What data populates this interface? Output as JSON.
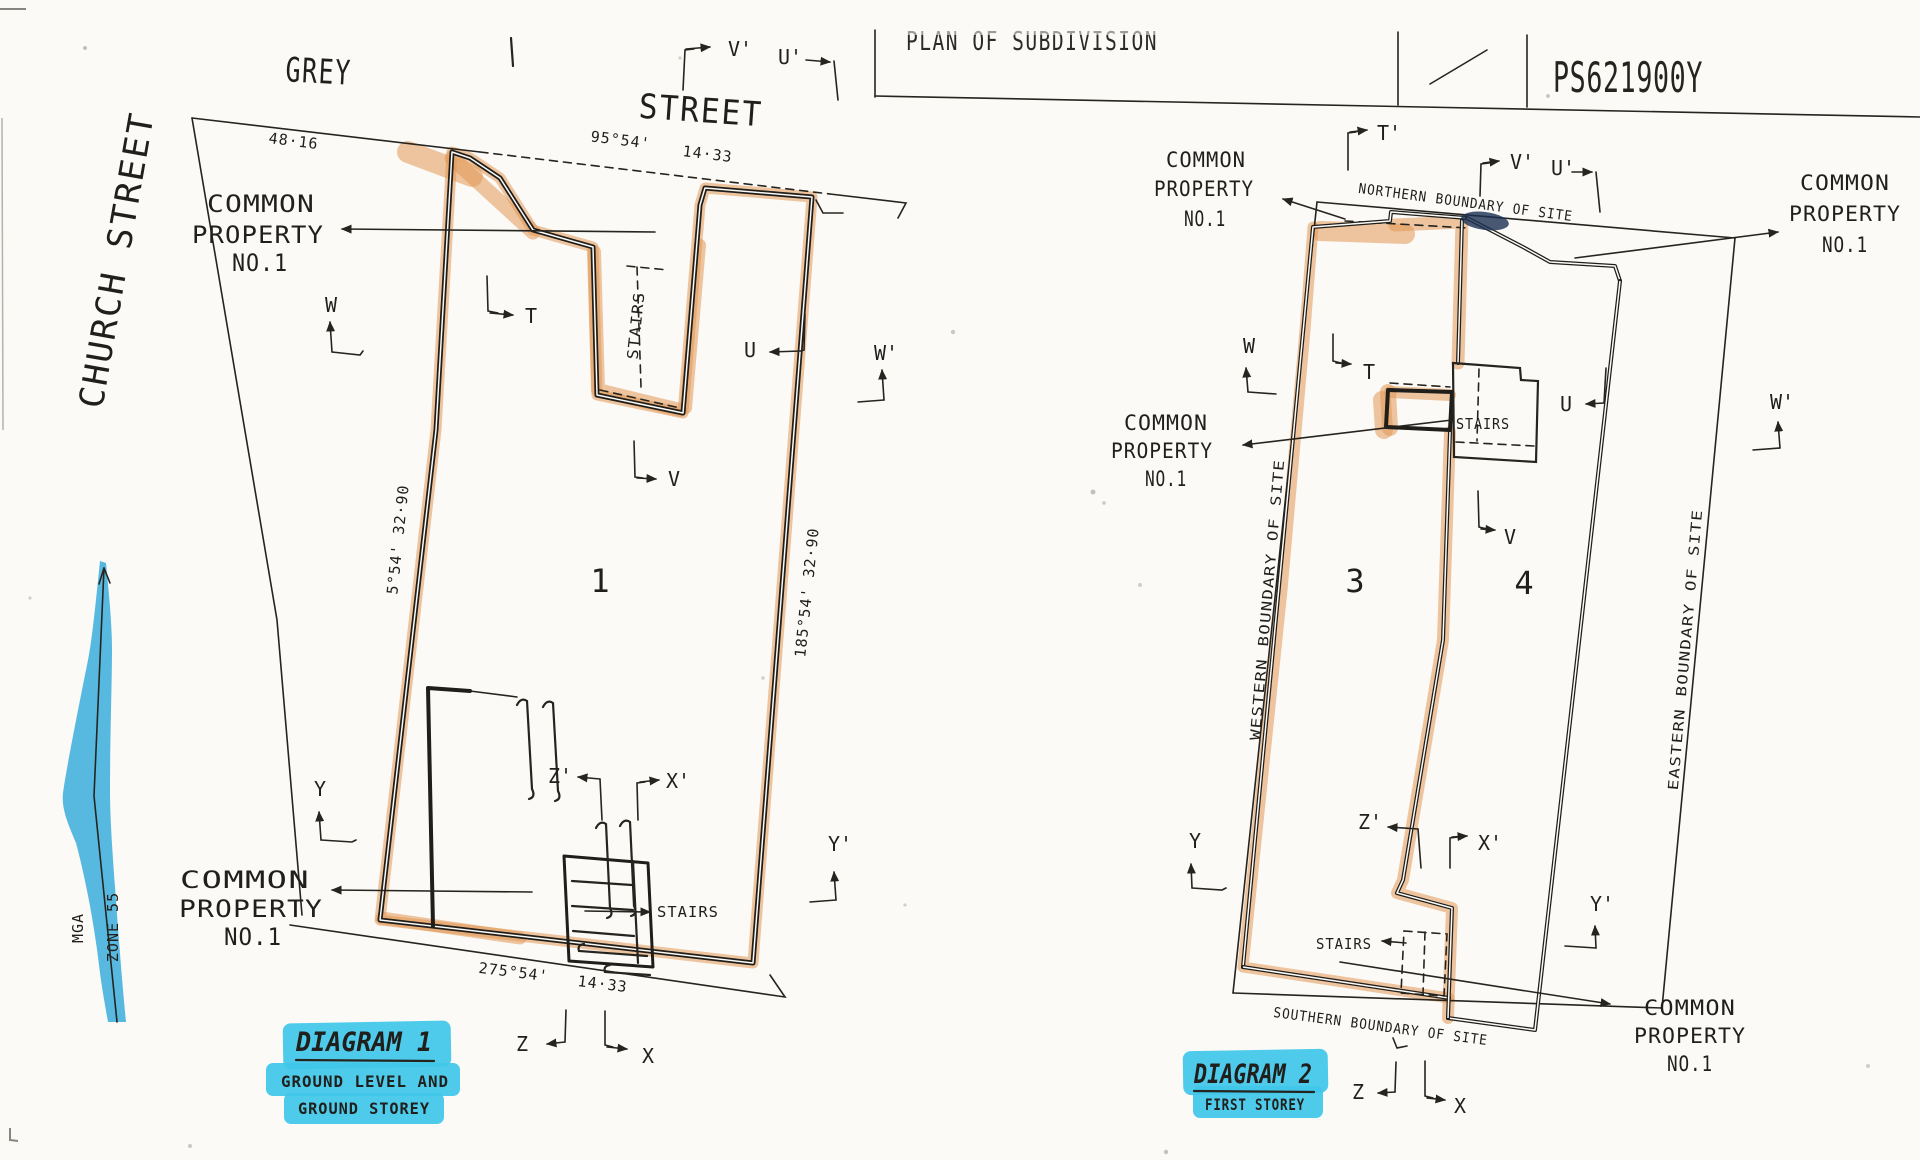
{
  "colors": {
    "highlight_orange": "#e19855",
    "highlight_cyan": "#3fc7e9",
    "highlight_blue": "#2fa9db",
    "ink": "#26241f"
  },
  "title_block": {
    "title": "PLAN OF SUBDIVISION",
    "plan_number": "PS621900Y"
  },
  "north_arrow": {
    "label": "MGA",
    "zone": "ZONE 55"
  },
  "diagram1": {
    "caption": {
      "title": "DIAGRAM 1",
      "line1": "GROUND LEVEL AND",
      "line2": "GROUND STOREY"
    },
    "streets": {
      "grey": "GREY",
      "street": "STREET",
      "church": "CHURCH STREET"
    },
    "lot": "1",
    "dims": {
      "street_frontage_left": "48·16",
      "street_bearing": "95°54'",
      "street_distance": "14·33",
      "west": "5°54'  32·90",
      "east": "185°54'  32·90",
      "south_bearing": "275°54'",
      "south_distance": "14·33"
    },
    "labels": {
      "common_property_top": [
        "COMMON",
        "PROPERTY",
        "NO.1"
      ],
      "common_property_bottom": [
        "COMMON",
        "PROPERTY",
        "NO.1"
      ],
      "stairs_top": "STAIRS",
      "stairs_bottom": "STAIRS"
    },
    "markers": {
      "v2": "V'",
      "u2": "U'",
      "w": "W",
      "t": "T",
      "u": "U",
      "w2": "W'",
      "v": "V",
      "y": "Y",
      "z2": "Z'",
      "x2": "X'",
      "y2": "Y'",
      "z": "Z",
      "x": "X"
    }
  },
  "diagram2": {
    "caption": {
      "title": "DIAGRAM 2",
      "line1": "FIRST STOREY"
    },
    "boundaries": {
      "north": "NORTHERN BOUNDARY OF SITE",
      "west": "WESTERN BOUNDARY OF SITE",
      "east": "EASTERN BOUNDARY OF SITE",
      "south": "SOUTHERN BOUNDARY OF SITE"
    },
    "lots": {
      "lot3": "3",
      "lot4": "4"
    },
    "labels": {
      "common_property_top_left": [
        "COMMON",
        "PROPERTY",
        "NO.1"
      ],
      "common_property_top_right": [
        "COMMON",
        "PROPERTY",
        "NO.1"
      ],
      "common_property_mid_left": [
        "COMMON",
        "PROPERTY",
        "NO.1"
      ],
      "common_property_bottom_right": [
        "COMMON",
        "PROPERTY",
        "NO.1"
      ],
      "stairs_mid": "STAIRS",
      "stairs_bottom": "STAIRS"
    },
    "markers": {
      "t2": "T'",
      "v2": "V'",
      "u2": "U'",
      "w": "W",
      "t": "T",
      "u": "U",
      "w2": "W'",
      "v": "V",
      "y": "Y",
      "z2": "Z'",
      "x2": "X'",
      "y2": "Y'",
      "z": "Z",
      "x": "X"
    }
  }
}
